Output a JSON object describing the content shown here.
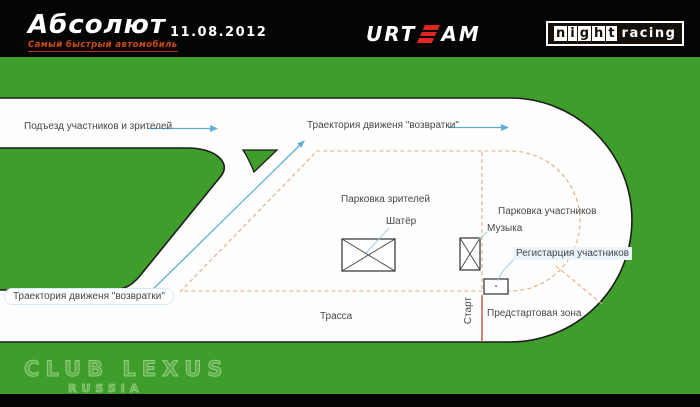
{
  "header": {
    "brand_title": "Абсолют",
    "brand_tagline": "Самый быстрый автомобиль",
    "date": "11.08.2012",
    "team_logo": {
      "text": "URTEAM",
      "left": "urt",
      "accent": "e",
      "right": "am"
    },
    "night_logo": {
      "letters": [
        "n",
        "i",
        "g",
        "h",
        "t"
      ],
      "suffix": "racing"
    }
  },
  "map": {
    "labels": {
      "approach": "Подъезд участников и зрителей",
      "return_top": "Траектория движеня  \"возвратки\"",
      "return_bottom": "Траектория движеня  \"возвратки\"",
      "spectator_parking": "Парковка зрителей",
      "participant_parking": "Парковка участников",
      "tent": "Шатёр",
      "music": "Музыка",
      "registration": "Регистарция участников",
      "track": "Трасса",
      "start": "Старт",
      "prestart": "Предстартовая зона"
    }
  },
  "watermark": {
    "line1": "CLUB LEXUS",
    "line2": "RUSSIA"
  },
  "colors": {
    "field_green": "#3E9D2B",
    "accent_red": "#E2261F",
    "tagline_orange": "#CF4A10",
    "dash_orange": "#E8A87A",
    "route_blue": "#5FAED9",
    "start_red": "#C9523F"
  }
}
